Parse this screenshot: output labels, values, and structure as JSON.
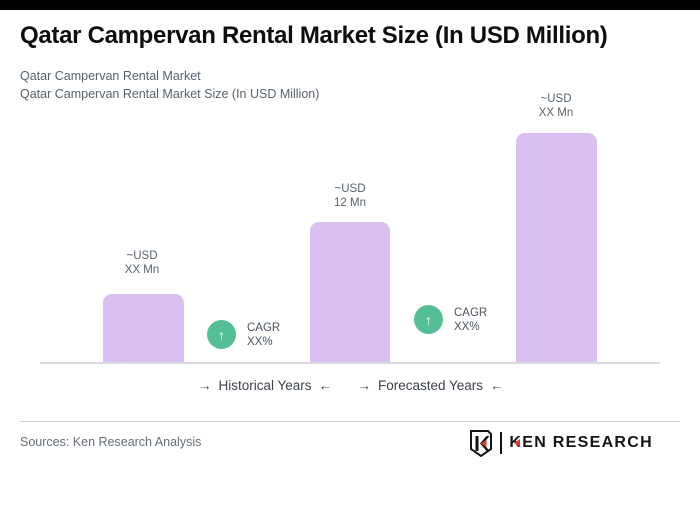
{
  "header": {
    "title": "Qatar Campervan Rental Market Size (In USD Million)",
    "subtitle_line1": "Qatar Campervan Rental Market",
    "subtitle_line2": "Qatar Campervan Rental Market Size (In USD Million)"
  },
  "chart_data": {
    "type": "bar",
    "title": "Qatar Campervan Rental Market Size (In USD Million)",
    "unit": "USD Million",
    "grid": false,
    "legend_position": "none",
    "bar_color": "#d9bff2",
    "badge_color": "#54bf97",
    "bars": [
      {
        "label_line1": "~USD",
        "label_line2": "XX Mn",
        "value_text": "~USD XX Mn",
        "estimated_value_usd_mn": 5.9,
        "height_px": 69
      },
      {
        "label_line1": "~USD",
        "label_line2": "12 Mn",
        "value_text": "~USD 12 Mn",
        "estimated_value_usd_mn": 12,
        "height_px": 141
      },
      {
        "label_line1": "~USD",
        "label_line2": "XX Mn",
        "value_text": "~USD XX Mn",
        "estimated_value_usd_mn": 19.6,
        "height_px": 230
      }
    ],
    "cagr_badges": [
      {
        "label_line1": "CAGR",
        "label_line2": "XX%"
      },
      {
        "label_line1": "CAGR",
        "label_line2": "XX%"
      }
    ],
    "axis_annotations": [
      {
        "label": "Historical Years"
      },
      {
        "label": "Forecasted Years"
      }
    ]
  },
  "icons": {
    "up_arrow": "↑",
    "right_arrow": "→",
    "left_arrow": "←"
  },
  "footer": {
    "sources": "Sources: Ken Research Analysis",
    "brand_k": "K",
    "brand_rest": "EN RESEARCH"
  }
}
